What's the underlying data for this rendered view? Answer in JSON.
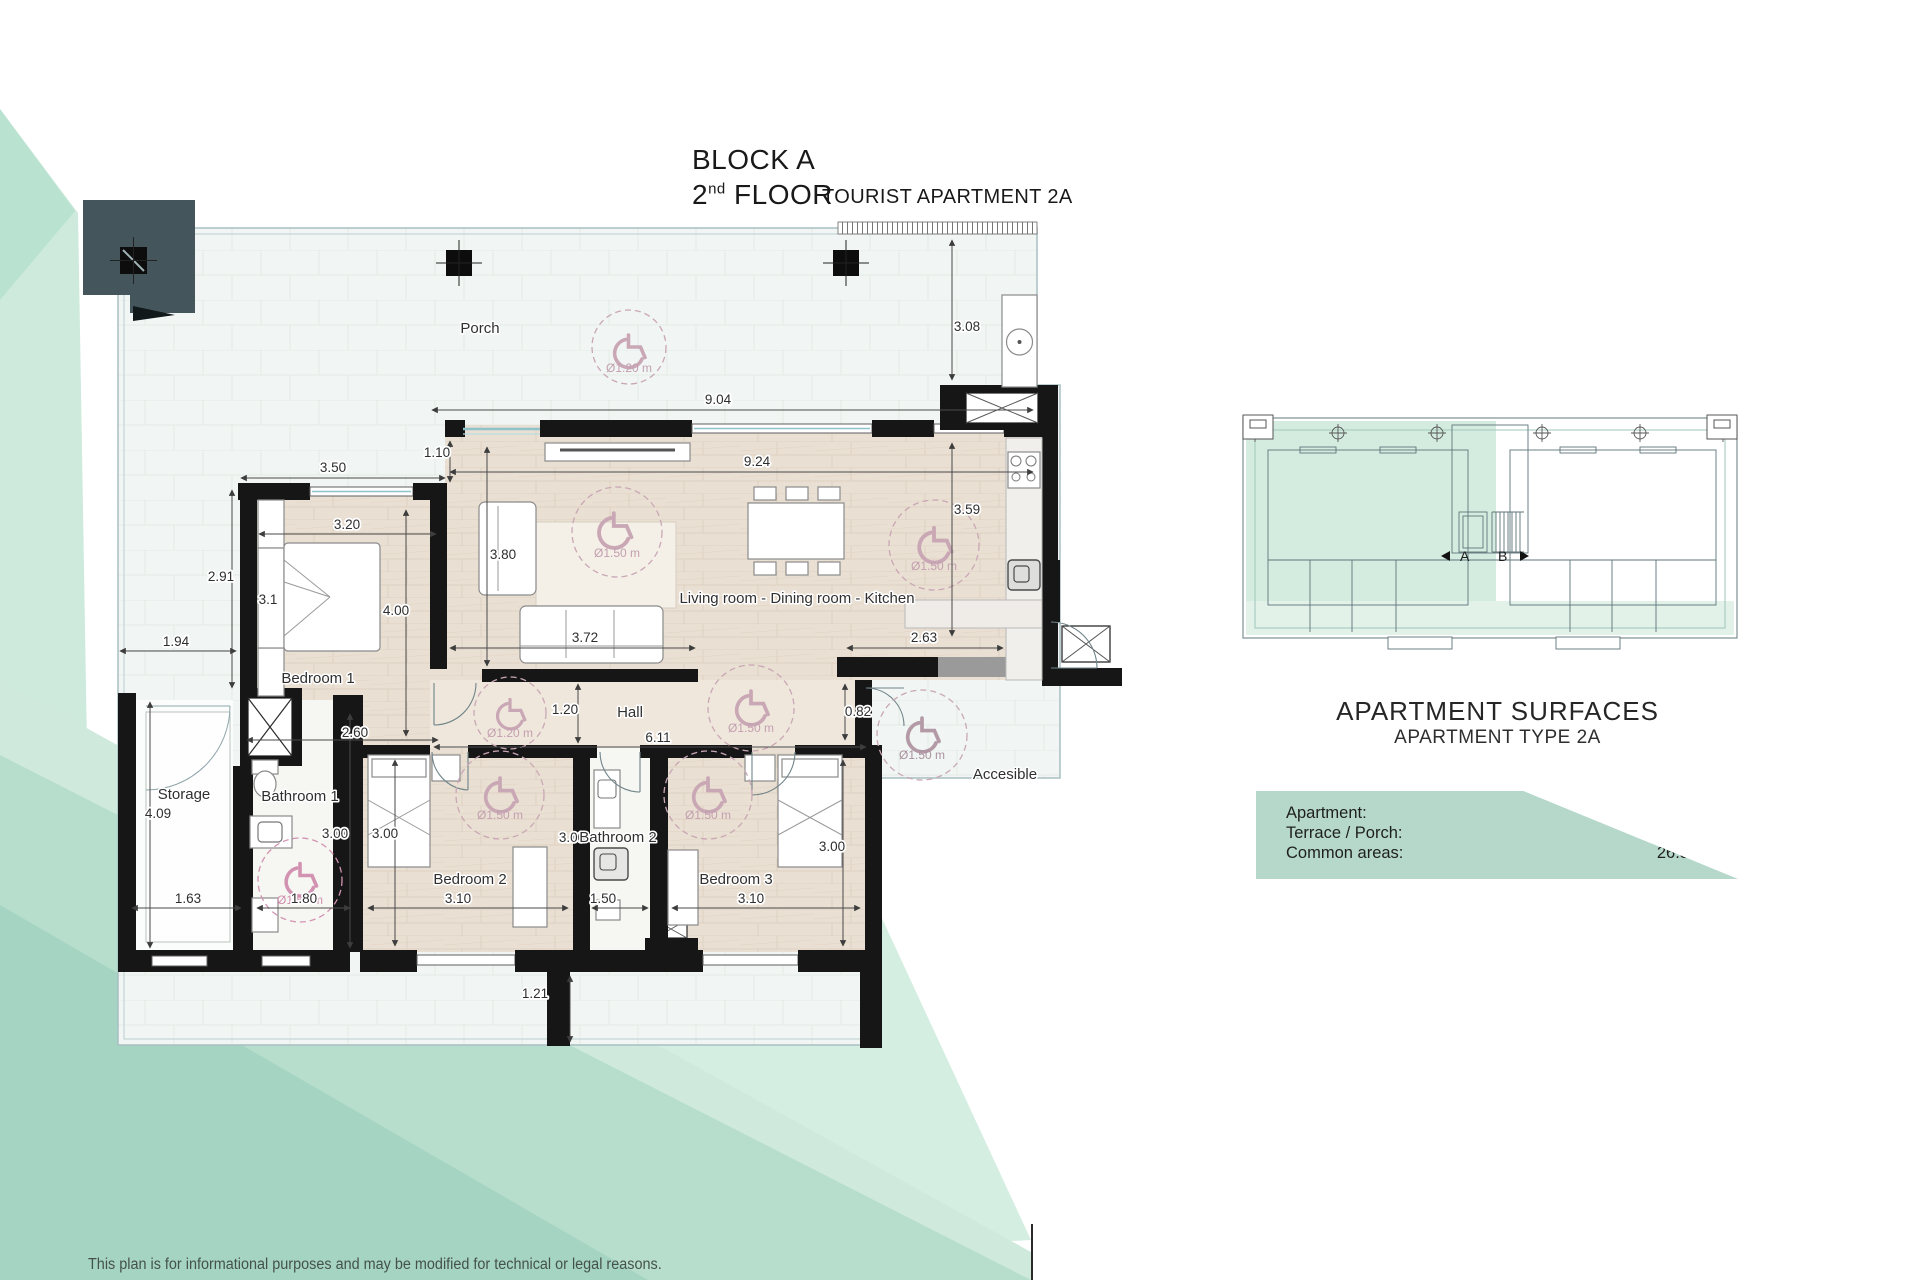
{
  "header": {
    "block": "BLOCK A",
    "floor_number": "2",
    "floor_ordinal": "nd",
    "floor_word": "FLOOR",
    "apartment_type": "TOURIST APARTMENT 2A"
  },
  "plan": {
    "rooms": {
      "porch": "Porch",
      "bedroom1": "Bedroom 1",
      "living": "Living room - Dining room - Kitchen",
      "hall": "Hall",
      "storage": "Storage",
      "bathroom1": "Bathroom 1",
      "bedroom2": "Bedroom 2",
      "bathroom2": "Bathroom 2",
      "bedroom3": "Bedroom 3",
      "accessible": "Accesible"
    },
    "dims": {
      "porch_h": "3.08",
      "porch_w": "9.04",
      "off110": "1.10",
      "living_w": "9.24",
      "bed1_top": "3.50",
      "bed1_in_w": "3.20",
      "bed1_left": "2.91",
      "living_left": "3.80",
      "bed1_in_h": "4.00",
      "bed_small": "3.1",
      "terr_left": "1.94",
      "sofa_w": "3.72",
      "kitch_w": "2.63",
      "kitch_h": "3.59",
      "hall_h": "1.20",
      "hall_w": "6.11",
      "entry_gap": "0.82",
      "bed1_bot": "2.60",
      "stor_h": "4.09",
      "stor_w": "1.63",
      "bath1_w": "1.80",
      "bath1_h": "3.00",
      "bed2_h": "3.00",
      "bed2_w": "3.10",
      "bath2_w": "1.50",
      "bath2_h": "3.00",
      "bed3_w": "3.10",
      "bed3_h": "3.00",
      "terr_bot": "1.21"
    },
    "wheel_labels": {
      "d120": "Ø1.20 m",
      "d150": "Ø1.50 m"
    }
  },
  "overview": {
    "unit_a": "A",
    "unit_b": "B"
  },
  "surfaces": {
    "title": "APARTMENT SURFACES",
    "subtitle": "APARTMENT TYPE 2A",
    "rows": [
      {
        "label": "Apartment:",
        "value": "106.20 m²"
      },
      {
        "label": "Terrace / Porch:",
        "value": "70.40 m²"
      },
      {
        "label": "Common areas:",
        "value": "26.50 m²"
      }
    ]
  },
  "footer": {
    "disclaimer": "This plan is for informational purposes and may be modified for technical or legal reasons."
  },
  "colors": {
    "mint_light": "#d8eee3",
    "mint_mid": "#b7decc",
    "mint_dark": "#a6d4c2",
    "table_green": "#b5d8cb",
    "wall_black": "#161616",
    "wood": "#e9dfd2",
    "wheel_pink": "#c49aae"
  }
}
